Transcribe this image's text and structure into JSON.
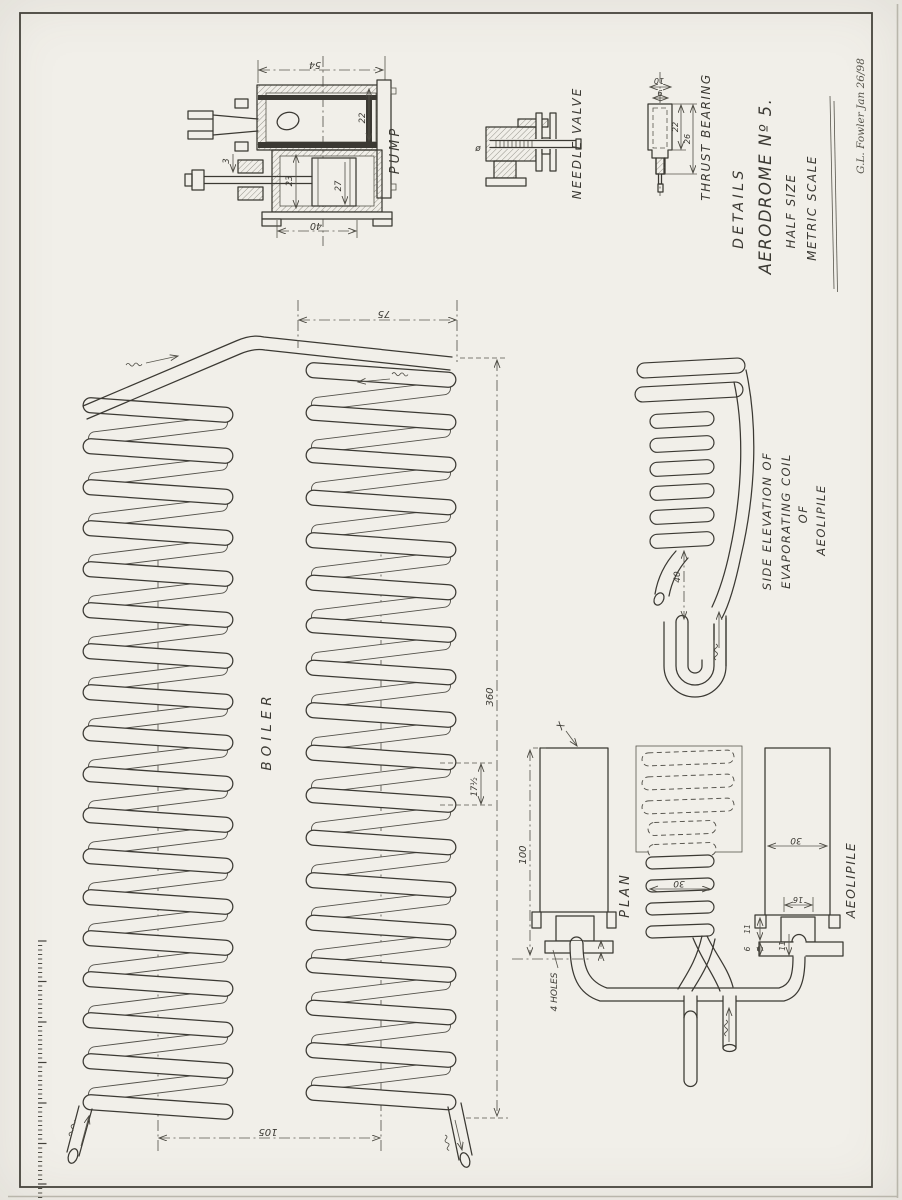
{
  "sheet": {
    "signature": "G.L. Fowler Jan 26/98",
    "title_block": {
      "details": "DETAILS",
      "name": "AERODROME Nº 5.",
      "size": "HALF SIZE",
      "scale": "METRIC SCALE"
    }
  },
  "pump": {
    "label": "PUMP",
    "dims": {
      "overall_width": "54",
      "cylinder_width": "40",
      "bore": "23",
      "stroke": "27",
      "chest": "22",
      "rod": "3"
    }
  },
  "needle_valve": {
    "label": "NEEDLE VALVE",
    "dia_mark": "ø"
  },
  "thrust_bearing": {
    "label": "THRUST BEARING",
    "dims": {
      "top": "10",
      "inner": "9",
      "body": "22",
      "overall": "26"
    }
  },
  "boiler": {
    "label": "BOILER",
    "dims": {
      "coil_width": "75",
      "length": "360",
      "centres": "105",
      "pitch": "17½"
    }
  },
  "evaporating_coil": {
    "labels": [
      "SIDE ELEVATION OF",
      "EVAPORATING COIL",
      "OF",
      "AEOLIPILE"
    ],
    "dims": {
      "drop": "40"
    }
  },
  "plan_view": {
    "label": "PLAN",
    "marker_x": "X",
    "holes_note": "4 HOLES",
    "dims": {
      "coil_dia": "30",
      "tank_height": "100"
    }
  },
  "aeolipile": {
    "label": "AEOLIPILE",
    "dims": {
      "width": "30",
      "neck": "16",
      "side": "11",
      "base": "6",
      "socket": "11"
    }
  }
}
